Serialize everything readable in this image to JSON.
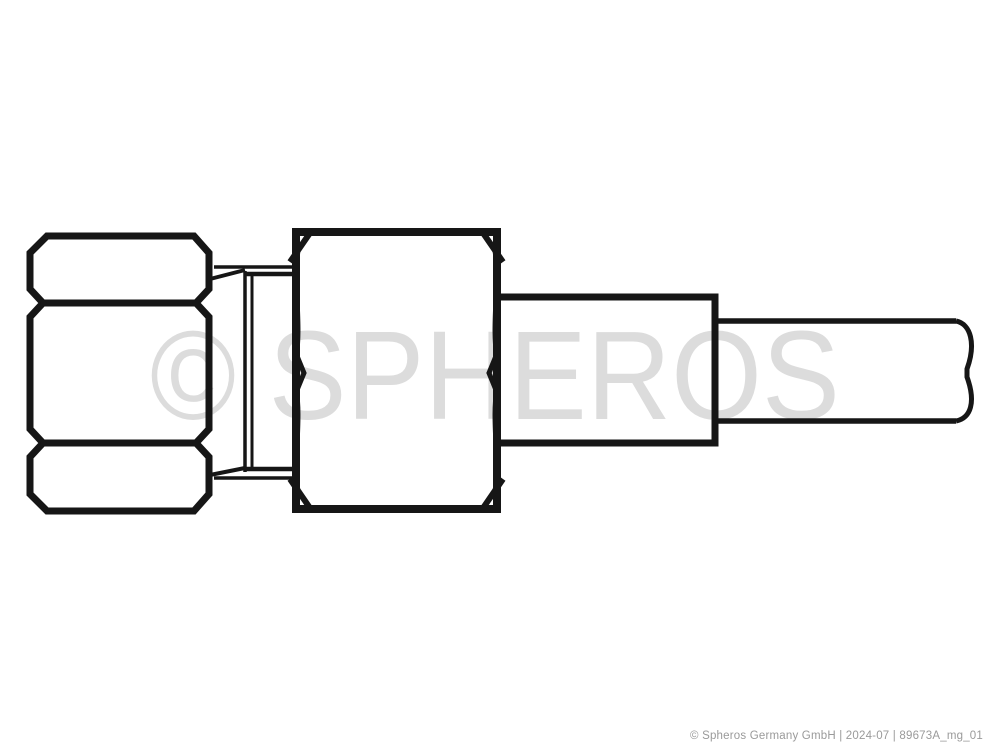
{
  "watermark": {
    "text": "© SPHEROS"
  },
  "footer": {
    "text": "© Spheros Germany GmbH | 2024-07 | 89673A_mg_01"
  },
  "colors": {
    "line": "#161616",
    "watermark_gray": "#dcdcdc",
    "footer_gray": "#9a9a9a",
    "background": "#ffffff"
  }
}
